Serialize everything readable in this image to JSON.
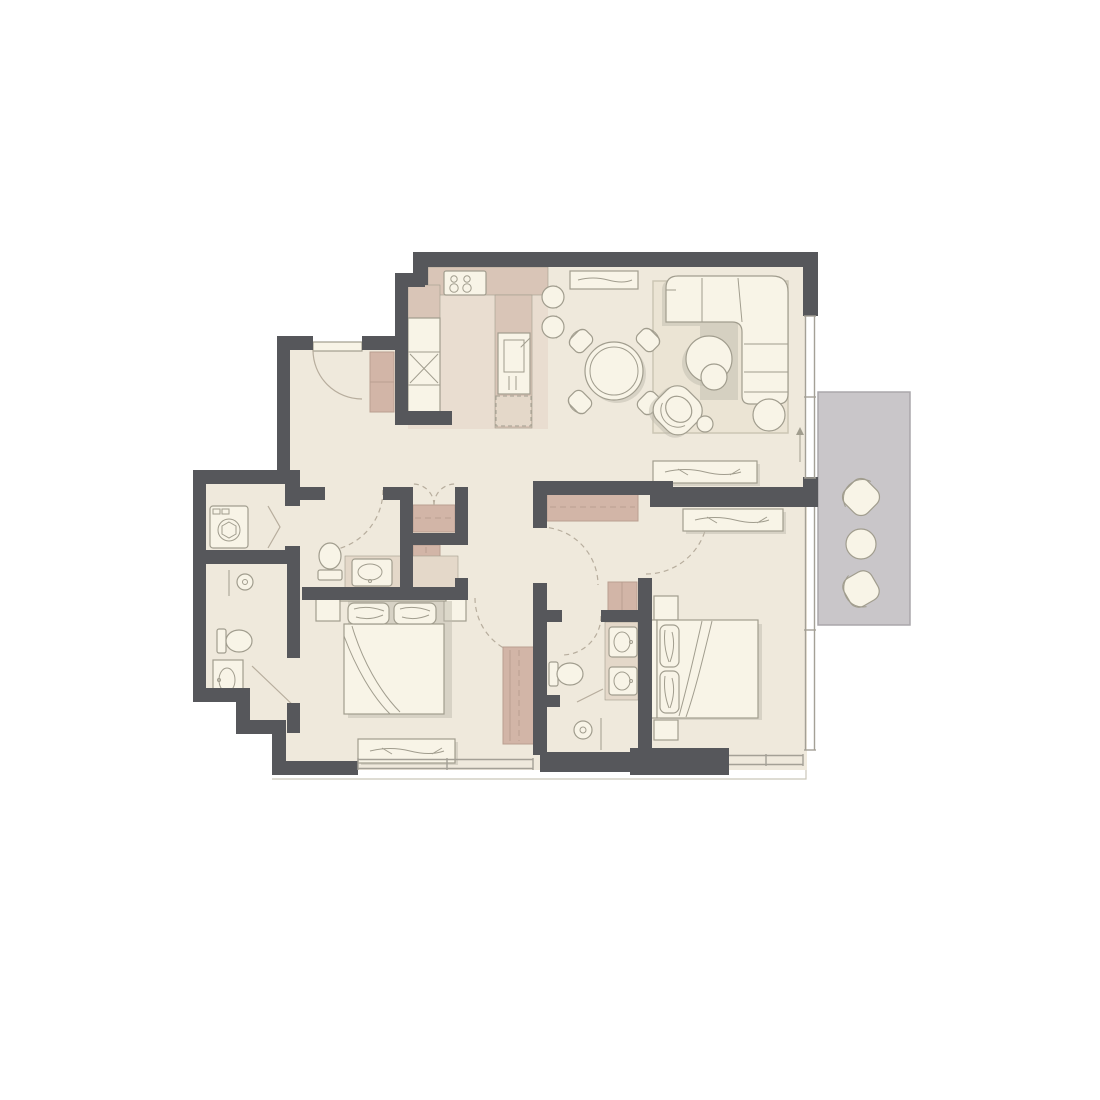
{
  "document": {
    "title": "Apartment floor plan",
    "type": "2D architectural floor plan, top-down view, no text labels"
  },
  "colors": {
    "background": "#ffffff",
    "wall": "#56575b",
    "floor": "#efe9dc",
    "kitchen-floor": "#e9ddd0",
    "counter": "#d9c5b7",
    "bath-counter": "#e4d8c9",
    "closet": "#d2b5a7",
    "closet-stroke": "#b99e90",
    "rug": "#ebe4d4",
    "rug-stroke": "#ccc6b4",
    "balcony": "#c9c6c9",
    "balcony-stroke": "#aaa7ab",
    "furn-fill": "#f8f4e7",
    "furn-stroke": "#a19d8e",
    "window-line": "#a4a096",
    "door-arc": "#b7ad9d",
    "shadow": "#c0bcae",
    "exterior-line": "#cac6b9"
  },
  "rooms": [
    {
      "name": "entry-hall",
      "features": [
        "entry-door-with-swing",
        "closet"
      ]
    },
    {
      "name": "kitchen",
      "features": [
        "cooktop-4-burners",
        "tall-cabinets",
        "cabinet-x-unit",
        "island-with-sink",
        "dishwasher-dashed"
      ]
    },
    {
      "name": "dining-area",
      "features": [
        "round-table",
        "4-chairs",
        "2-bar-stools",
        "sideboard"
      ]
    },
    {
      "name": "living-area",
      "features": [
        "l-shaped-sofa",
        "rug",
        "round-coffee-table",
        "nesting-table",
        "ottoman",
        "swivel-armchair",
        "side-table"
      ]
    },
    {
      "name": "balcony",
      "features": [
        "2-lounge-chairs",
        "round-table"
      ]
    },
    {
      "name": "storage-niche",
      "features": [
        "double-door-closet",
        "linen-closet"
      ]
    },
    {
      "name": "laundry-closet",
      "features": [
        "washing-machine",
        "bifold-door"
      ]
    },
    {
      "name": "bathroom-left",
      "features": [
        "shower",
        "toilet",
        "vanity-sink",
        "pivot-door"
      ]
    },
    {
      "name": "powder-room",
      "features": [
        "toilet",
        "vanity-sink"
      ]
    },
    {
      "name": "bedroom-1",
      "features": [
        "double-bed",
        "2-pillows",
        "2-nightstands",
        "dresser",
        "wardrobe"
      ]
    },
    {
      "name": "bedroom-2",
      "features": [
        "double-bed",
        "2-pillows",
        "2-nightstands",
        "dresser",
        "wardrobe",
        "closet"
      ]
    },
    {
      "name": "ensuite-bathroom",
      "features": [
        "double-sink-vanity",
        "toilet",
        "shower"
      ]
    }
  ],
  "annotations": {
    "entrance-arrow-direction": "up"
  },
  "counts": {
    "bedrooms": 2,
    "bathrooms": 3,
    "balconies": 1,
    "door-swing-arcs": 7,
    "window-strips": 4
  }
}
